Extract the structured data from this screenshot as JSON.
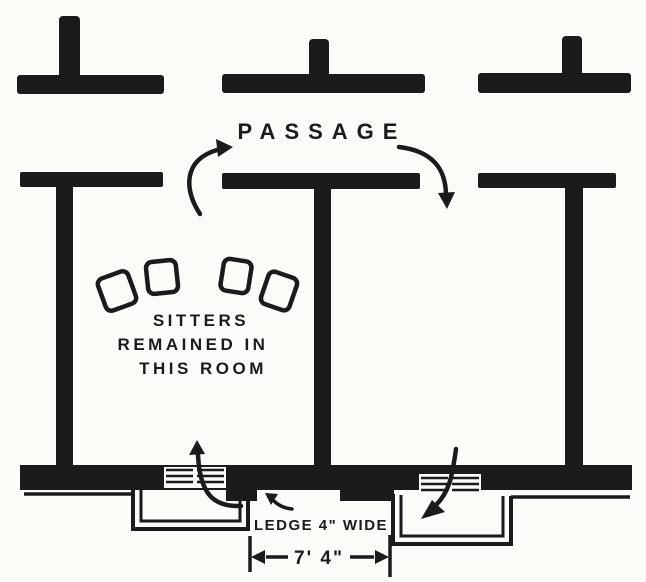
{
  "figure": {
    "ink_color": "#1b1b1b",
    "paper_color": "#fcfbf8",
    "labels": {
      "passage": "PASSAGE",
      "sitters_note_line1": "SITTERS",
      "sitters_note_line2": "REMAINED IN",
      "sitters_note_line3": "THIS ROOM",
      "ledge_note": "LEDGE 4\" WIDE",
      "dimension": "7' 4\""
    },
    "elements": {
      "chairs_count": 4,
      "arrows": [
        {
          "name": "arrow-into-passage",
          "direction": "up-right",
          "meaning": "route through left doorway into passage"
        },
        {
          "name": "arrow-from-passage",
          "direction": "down",
          "meaning": "route from passage through right doorway"
        },
        {
          "name": "arrow-through-left-window",
          "direction": "up",
          "meaning": "route in through left bay window"
        },
        {
          "name": "arrow-through-right-window",
          "direction": "down-left",
          "meaning": "route out through right bay window"
        },
        {
          "name": "arrow-to-ledge",
          "direction": "up-left",
          "meaning": "pointer to ledge"
        }
      ]
    }
  }
}
